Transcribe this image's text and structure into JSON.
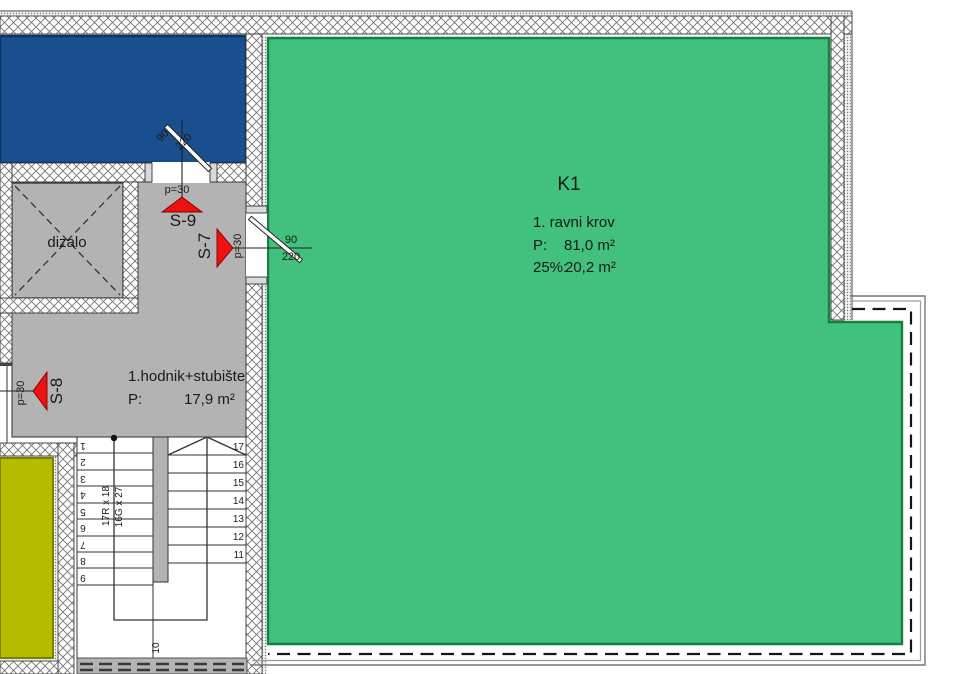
{
  "plan": {
    "k1": {
      "name": "K1",
      "subtitle": "1. ravni krov",
      "area_label": "P:",
      "area_value": "81,0 m²",
      "pct_label": "25%:",
      "pct_value": "20,2 m²"
    },
    "hodnik": {
      "name": "1.hodnik+stubište",
      "area_label": "P:",
      "area_value": "17,9 m²"
    },
    "dizalo_label": "dizalo",
    "sections": {
      "s9": {
        "label": "S-9",
        "slope": "p=30"
      },
      "s7": {
        "label": "S-7",
        "slope": "p=30"
      },
      "s8": {
        "label": "S-8",
        "slope": "p=30"
      }
    },
    "doors": {
      "top": {
        "width": "90",
        "height": "220"
      },
      "right": {
        "width": "90",
        "height": "220"
      }
    },
    "stairs": {
      "risers": "17R x 18",
      "goings": "16G x 27",
      "treads": [
        "1",
        "2",
        "3",
        "4",
        "5",
        "6",
        "7",
        "8",
        "9",
        "10",
        "11",
        "12",
        "13",
        "14",
        "15",
        "16",
        "17"
      ]
    },
    "colors": {
      "roof_green": "#41c17d",
      "terrace_blue": "#1a4f8f",
      "room_yellow": "#b5bc00",
      "corridor_gray": "#b3b3b3",
      "marker_red": "#ee1111"
    }
  }
}
